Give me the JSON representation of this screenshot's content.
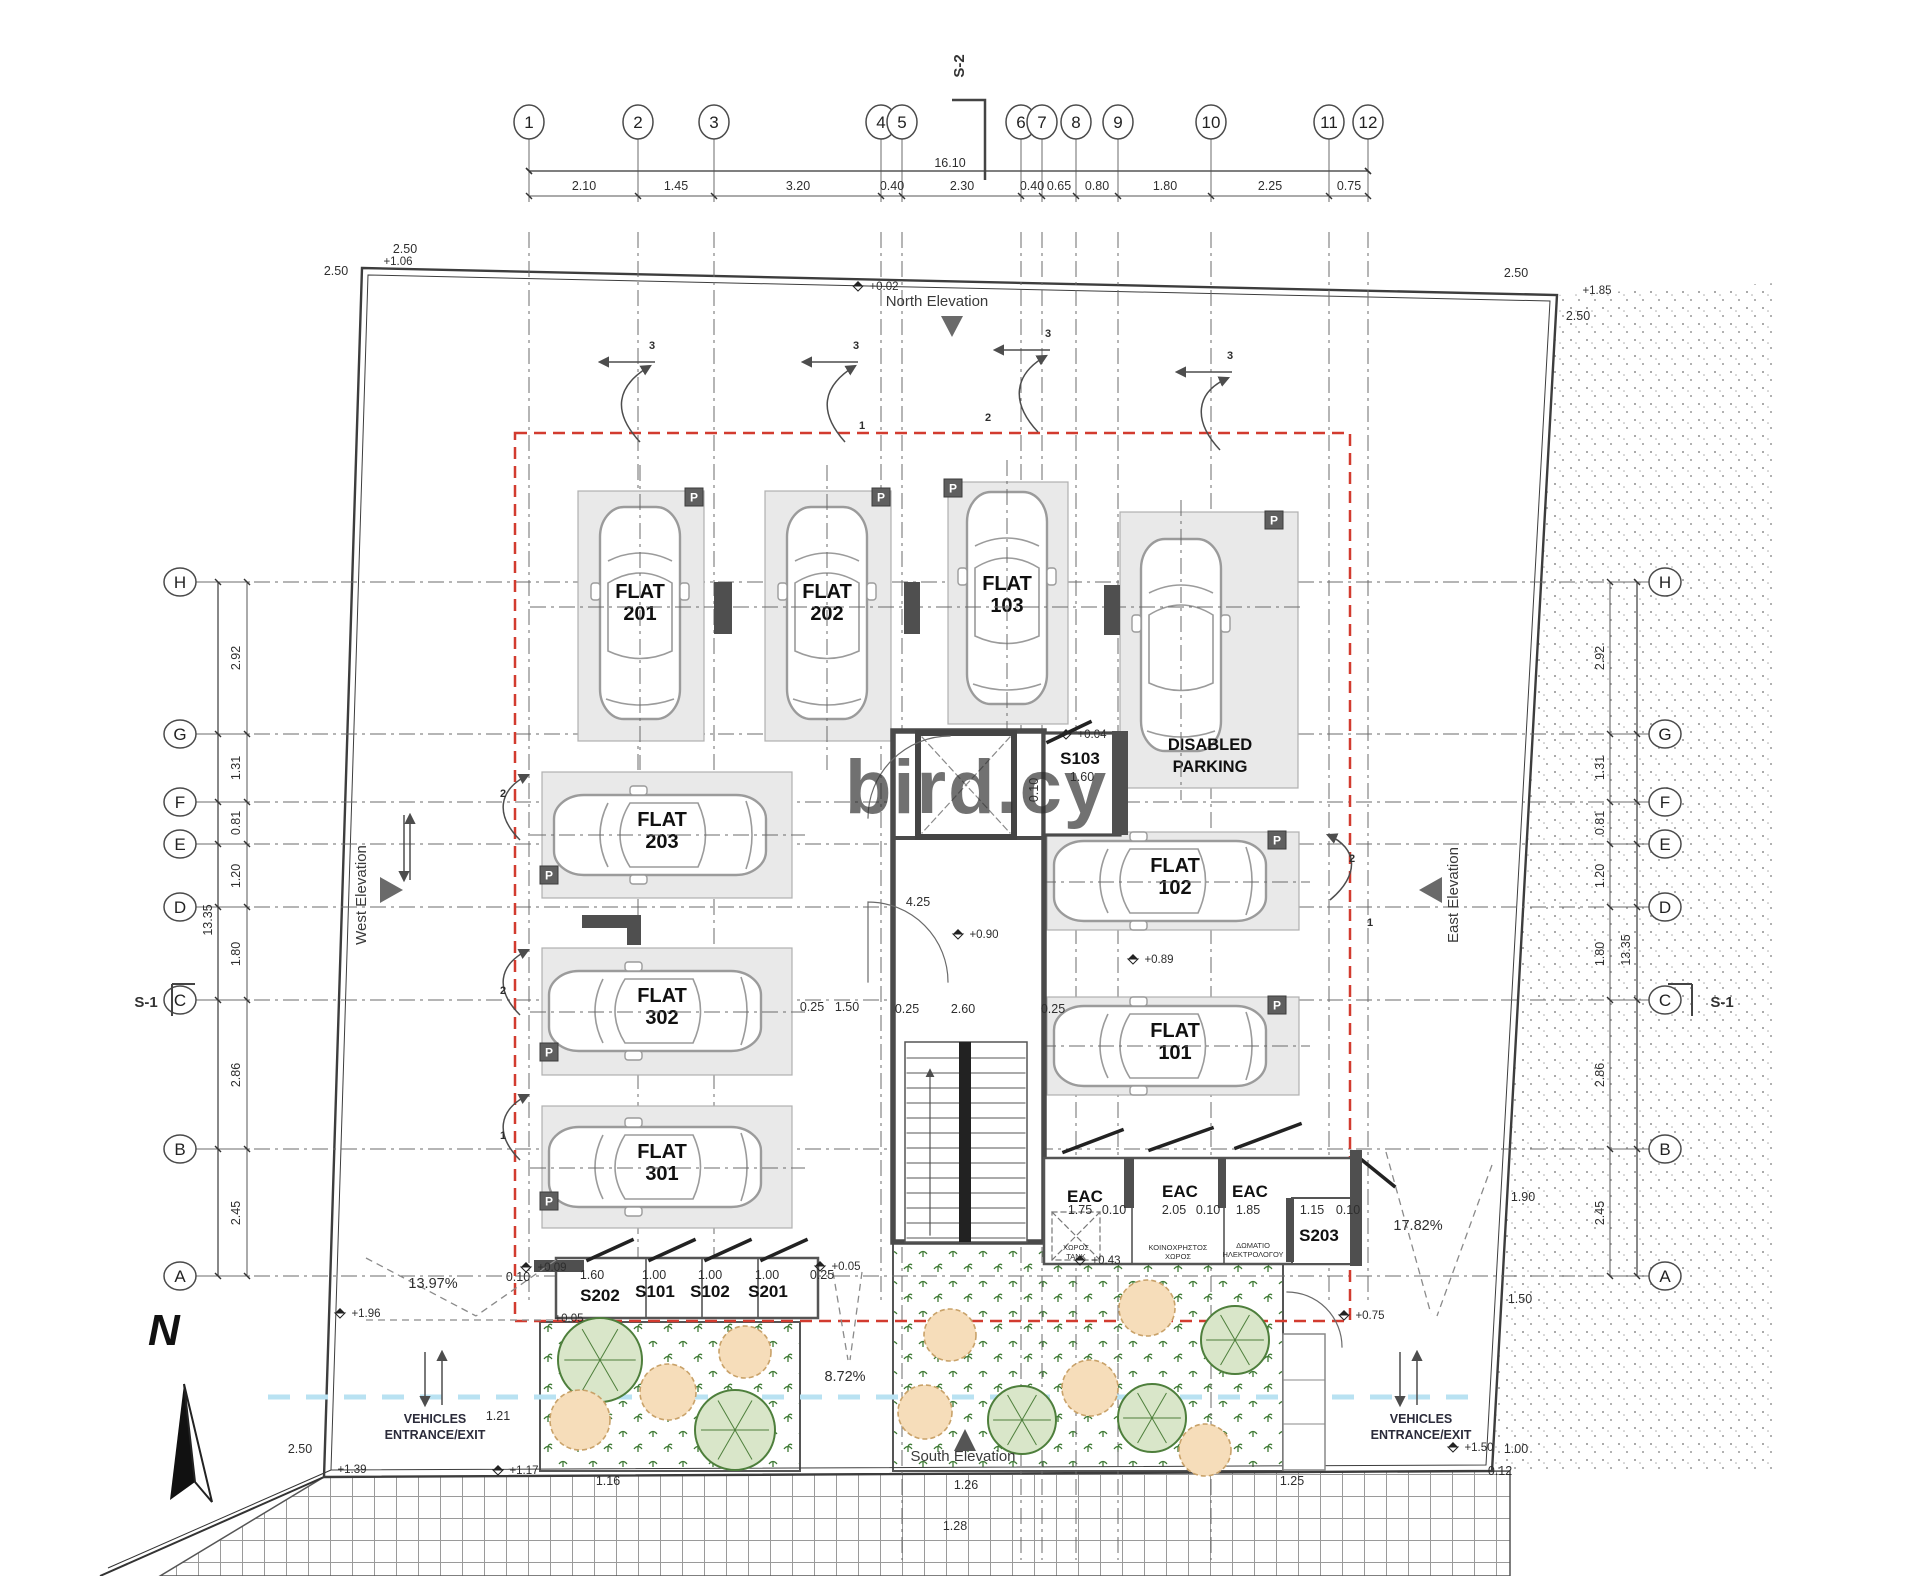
{
  "watermark": {
    "text": "bird.cy",
    "color": "#6e8ec9"
  },
  "compass": {
    "label": "N"
  },
  "section_labels": {
    "s2": "S-2",
    "s1_left": "S-1",
    "s1_right": "S-1"
  },
  "elevation_labels": {
    "north": "North Elevation",
    "south": "South Elevation",
    "west": "West Elevation",
    "east": "East Elevation"
  },
  "entrance_left": {
    "line1": "VEHICLES",
    "line2": "ENTRANCE/EXIT"
  },
  "entrance_right": {
    "line1": "VEHICLES",
    "line2": "ENTRANCE/EXIT"
  },
  "parking_icon": {
    "glyph": "P"
  },
  "grid": {
    "bubble_y": 122,
    "row_x_left": 180,
    "row_x_right": 1665,
    "columns": [
      {
        "label": "1",
        "x": 529
      },
      {
        "label": "2",
        "x": 638
      },
      {
        "label": "3",
        "x": 714
      },
      {
        "label": "4",
        "x": 881
      },
      {
        "label": "5",
        "x": 902
      },
      {
        "label": "6",
        "x": 1021
      },
      {
        "label": "7",
        "x": 1042
      },
      {
        "label": "8",
        "x": 1076
      },
      {
        "label": "9",
        "x": 1118
      },
      {
        "label": "10",
        "x": 1211
      },
      {
        "label": "11",
        "x": 1329
      },
      {
        "label": "12",
        "x": 1368
      }
    ],
    "rows": [
      {
        "label": "H",
        "y": 582
      },
      {
        "label": "G",
        "y": 734
      },
      {
        "label": "F",
        "y": 802
      },
      {
        "label": "E",
        "y": 844
      },
      {
        "label": "D",
        "y": 907
      },
      {
        "label": "C",
        "y": 1000
      },
      {
        "label": "B",
        "y": 1149
      },
      {
        "label": "A",
        "y": 1276
      }
    ]
  },
  "dims": {
    "top_total": "16.10",
    "left_total": "13.35",
    "right_total": "13.35",
    "top_segments": [
      {
        "t": "2.10",
        "x": 584
      },
      {
        "t": "1.45",
        "x": 676
      },
      {
        "t": "3.20",
        "x": 798
      },
      {
        "t": "0.40",
        "x": 892
      },
      {
        "t": "2.30",
        "x": 962
      },
      {
        "t": "0.40",
        "x": 1032
      },
      {
        "t": "0.65",
        "x": 1059
      },
      {
        "t": "0.80",
        "x": 1097
      },
      {
        "t": "1.80",
        "x": 1165
      },
      {
        "t": "2.25",
        "x": 1270
      },
      {
        "t": "0.75",
        "x": 1349
      }
    ],
    "left_segments": [
      {
        "t": "2.92",
        "y": 658
      },
      {
        "t": "1.31",
        "y": 768
      },
      {
        "t": "0.81",
        "y": 823
      },
      {
        "t": "1.20",
        "y": 876
      },
      {
        "t": "1.80",
        "y": 954
      },
      {
        "t": "2.86",
        "y": 1075
      },
      {
        "t": "2.45",
        "y": 1213
      }
    ],
    "right_segments": [
      {
        "t": "2.92",
        "y": 658
      },
      {
        "t": "1.31",
        "y": 768
      },
      {
        "t": "0.81",
        "y": 823
      },
      {
        "t": "1.20",
        "y": 876
      },
      {
        "t": "1.80",
        "y": 954
      },
      {
        "t": "2.86",
        "y": 1075
      },
      {
        "t": "2.45",
        "y": 1213
      }
    ]
  },
  "stalls": [
    {
      "id": "stall-flat-201",
      "line1": "FLAT",
      "line2": "201",
      "x": 578,
      "y": 491,
      "w": 126,
      "h": 250,
      "car": "v",
      "cx": 640,
      "cy": 613,
      "lx": 640,
      "ly": 598,
      "p": [
        694,
        497
      ]
    },
    {
      "id": "stall-flat-202",
      "line1": "FLAT",
      "line2": "202",
      "x": 765,
      "y": 491,
      "w": 126,
      "h": 250,
      "car": "v",
      "cx": 827,
      "cy": 613,
      "lx": 827,
      "ly": 598,
      "p": [
        881,
        497
      ]
    },
    {
      "id": "stall-flat-103",
      "line1": "FLAT",
      "line2": "103",
      "x": 948,
      "y": 482,
      "w": 120,
      "h": 242,
      "car": "v",
      "cx": 1007,
      "cy": 598,
      "lx": 1007,
      "ly": 590,
      "p": [
        953,
        488
      ]
    },
    {
      "id": "stall-disabled",
      "line1": "DISABLED",
      "line2": "PARKING",
      "x": 1120,
      "y": 512,
      "w": 178,
      "h": 276,
      "car": "v",
      "cx": 1181,
      "cy": 645,
      "lx": 1210,
      "ly": 750,
      "p": [
        1274,
        520
      ],
      "dis": 1
    },
    {
      "id": "stall-flat-203",
      "line1": "FLAT",
      "line2": "203",
      "x": 542,
      "y": 772,
      "w": 250,
      "h": 126,
      "car": "h",
      "cx": 660,
      "cy": 835,
      "lx": 662,
      "ly": 826,
      "p": [
        549,
        875
      ]
    },
    {
      "id": "stall-flat-302",
      "line1": "FLAT",
      "line2": "302",
      "x": 542,
      "y": 948,
      "w": 250,
      "h": 127,
      "car": "h",
      "cx": 655,
      "cy": 1011,
      "lx": 662,
      "ly": 1002,
      "p": [
        549,
        1052
      ]
    },
    {
      "id": "stall-flat-301",
      "line1": "FLAT",
      "line2": "301",
      "x": 542,
      "y": 1106,
      "w": 250,
      "h": 122,
      "car": "h",
      "cx": 655,
      "cy": 1167,
      "lx": 662,
      "ly": 1158,
      "p": [
        549,
        1201
      ]
    },
    {
      "id": "stall-flat-102",
      "line1": "FLAT",
      "line2": "102",
      "x": 1047,
      "y": 832,
      "w": 252,
      "h": 98,
      "car": "h",
      "cx": 1160,
      "cy": 881,
      "lx": 1175,
      "ly": 872,
      "p": [
        1277,
        840
      ]
    },
    {
      "id": "stall-flat-101",
      "line1": "FLAT",
      "line2": "101",
      "x": 1047,
      "y": 997,
      "w": 252,
      "h": 98,
      "car": "h",
      "cx": 1160,
      "cy": 1046,
      "lx": 1175,
      "ly": 1037,
      "p": [
        1277,
        1005
      ]
    }
  ],
  "texts": [
    {
      "t": "4.25",
      "x": 918,
      "y": 906,
      "c": "d"
    },
    {
      "t": "0.25",
      "x": 812,
      "y": 1011,
      "c": "d"
    },
    {
      "t": "1.50",
      "x": 847,
      "y": 1011,
      "c": "d"
    },
    {
      "t": "0.25",
      "x": 907,
      "y": 1013,
      "c": "d"
    },
    {
      "t": "2.60",
      "x": 963,
      "y": 1013,
      "c": "d"
    },
    {
      "t": "0.25",
      "x": 1053,
      "y": 1013,
      "c": "d"
    },
    {
      "t": "1.60",
      "x": 1082,
      "y": 781,
      "c": "d"
    },
    {
      "t": "0.10",
      "x": 1038,
      "y": 790,
      "c": "d",
      "r": 1
    },
    {
      "t": "1.60",
      "x": 592,
      "y": 1279,
      "c": "d"
    },
    {
      "t": "1.00",
      "x": 654,
      "y": 1279,
      "c": "d"
    },
    {
      "t": "1.00",
      "x": 710,
      "y": 1279,
      "c": "d"
    },
    {
      "t": "1.00",
      "x": 767,
      "y": 1279,
      "c": "d"
    },
    {
      "t": "0.25",
      "x": 822,
      "y": 1279,
      "c": "d"
    },
    {
      "t": "0.10",
      "x": 518,
      "y": 1281,
      "c": "d"
    },
    {
      "t": "1.75",
      "x": 1080,
      "y": 1214,
      "c": "d"
    },
    {
      "t": "0.10",
      "x": 1114,
      "y": 1214,
      "c": "d"
    },
    {
      "t": "2.05",
      "x": 1174,
      "y": 1214,
      "c": "d"
    },
    {
      "t": "0.10",
      "x": 1208,
      "y": 1214,
      "c": "d"
    },
    {
      "t": "1.85",
      "x": 1248,
      "y": 1214,
      "c": "d"
    },
    {
      "t": "1.15",
      "x": 1312,
      "y": 1214,
      "c": "d"
    },
    {
      "t": "0.10",
      "x": 1348,
      "y": 1214,
      "c": "d"
    },
    {
      "t": "1.90",
      "x": 1523,
      "y": 1201,
      "c": "d"
    },
    {
      "t": "1.50",
      "x": 1520,
      "y": 1303,
      "c": "d"
    },
    {
      "t": "1.00",
      "x": 1516,
      "y": 1453,
      "c": "d"
    },
    {
      "t": "0.12",
      "x": 1500,
      "y": 1475,
      "c": "d"
    },
    {
      "t": "1.21",
      "x": 498,
      "y": 1420,
      "c": "d"
    },
    {
      "t": "1.26",
      "x": 966,
      "y": 1489,
      "c": "d"
    },
    {
      "t": "1.16",
      "x": 608,
      "y": 1485,
      "c": "d"
    },
    {
      "t": "1.25",
      "x": 1292,
      "y": 1485,
      "c": "d"
    },
    {
      "t": "1.28",
      "x": 955,
      "y": 1530,
      "c": "d"
    },
    {
      "t": "2.50",
      "x": 405,
      "y": 253,
      "c": "d"
    },
    {
      "t": "2.50",
      "x": 336,
      "y": 275,
      "c": "d"
    },
    {
      "t": "2.50",
      "x": 1516,
      "y": 277,
      "c": "d"
    },
    {
      "t": "2.50",
      "x": 1578,
      "y": 320,
      "c": "d"
    },
    {
      "t": "2.50",
      "x": 300,
      "y": 1453,
      "c": "d"
    },
    {
      "t": "+0.02",
      "x": 884,
      "y": 290,
      "c": "l",
      "m": 1
    },
    {
      "t": "+1.06",
      "x": 398,
      "y": 265,
      "c": "l"
    },
    {
      "t": "+1.85",
      "x": 1597,
      "y": 294,
      "c": "l"
    },
    {
      "t": "+1.96",
      "x": 366,
      "y": 1317,
      "c": "l",
      "m": 1
    },
    {
      "t": "+1.39",
      "x": 352,
      "y": 1473,
      "c": "l"
    },
    {
      "t": "+1.17",
      "x": 524,
      "y": 1474,
      "c": "l",
      "m": 1
    },
    {
      "t": "+0.09",
      "x": 552,
      "y": 1271,
      "c": "l",
      "m": 1
    },
    {
      "t": "+0.05",
      "x": 569,
      "y": 1322,
      "c": "l"
    },
    {
      "t": "+0.05",
      "x": 846,
      "y": 1270,
      "c": "l",
      "m": 1
    },
    {
      "t": "+0.90",
      "x": 984,
      "y": 938,
      "c": "l",
      "m": 1
    },
    {
      "t": "+0.04",
      "x": 1092,
      "y": 738,
      "c": "l",
      "m": 1
    },
    {
      "t": "+0.89",
      "x": 1159,
      "y": 963,
      "c": "l",
      "m": 1
    },
    {
      "t": "+0.43",
      "x": 1106,
      "y": 1264,
      "c": "l",
      "m": 1
    },
    {
      "t": "+0.75",
      "x": 1370,
      "y": 1319,
      "c": "l",
      "m": 1
    },
    {
      "t": "+1.50",
      "x": 1479,
      "y": 1451,
      "c": "l",
      "m": 1
    },
    {
      "t": "13.97%",
      "x": 433,
      "y": 1288,
      "c": "pct"
    },
    {
      "t": "17.82%",
      "x": 1418,
      "y": 1230,
      "c": "pct"
    },
    {
      "t": "8.72%",
      "x": 845,
      "y": 1381,
      "c": "pct"
    },
    {
      "t": "3",
      "x": 652,
      "y": 349,
      "c": "p"
    },
    {
      "t": "3",
      "x": 856,
      "y": 349,
      "c": "p"
    },
    {
      "t": "3",
      "x": 1048,
      "y": 337,
      "c": "p"
    },
    {
      "t": "3",
      "x": 1230,
      "y": 359,
      "c": "p"
    },
    {
      "t": "1",
      "x": 862,
      "y": 429,
      "c": "p"
    },
    {
      "t": "2",
      "x": 988,
      "y": 421,
      "c": "p"
    },
    {
      "t": "2",
      "x": 503,
      "y": 797,
      "c": "p"
    },
    {
      "t": "2",
      "x": 503,
      "y": 994,
      "c": "p"
    },
    {
      "t": "1",
      "x": 503,
      "y": 1139,
      "c": "p"
    },
    {
      "t": "2",
      "x": 1352,
      "y": 862,
      "c": "p"
    },
    {
      "t": "1",
      "x": 1370,
      "y": 926,
      "c": "p"
    },
    {
      "t": "S103",
      "x": 1080,
      "y": 764,
      "c": "r"
    },
    {
      "t": "EAC",
      "x": 1085,
      "y": 1202,
      "c": "r"
    },
    {
      "t": "EAC",
      "x": 1180,
      "y": 1197,
      "c": "r"
    },
    {
      "t": "EAC",
      "x": 1250,
      "y": 1197,
      "c": "r"
    },
    {
      "t": "S203",
      "x": 1319,
      "y": 1241,
      "c": "r"
    },
    {
      "t": "S202",
      "x": 600,
      "y": 1301,
      "c": "r"
    },
    {
      "t": "S101",
      "x": 655,
      "y": 1297,
      "c": "r"
    },
    {
      "t": "S102",
      "x": 710,
      "y": 1297,
      "c": "r"
    },
    {
      "t": "S201",
      "x": 768,
      "y": 1297,
      "c": "r"
    },
    {
      "t": "ΧΩΡΟΣ",
      "x": 1076,
      "y": 1250,
      "c": "s"
    },
    {
      "t": "ΤΑΝΚ",
      "x": 1076,
      "y": 1259,
      "c": "s"
    },
    {
      "t": "ΚΟΙΝΟΧΡΗΣΤΟΣ",
      "x": 1178,
      "y": 1250,
      "c": "s"
    },
    {
      "t": "ΧΩΡΟΣ",
      "x": 1178,
      "y": 1259,
      "c": "s"
    },
    {
      "t": "ΔΩΜΑΤΙΟ",
      "x": 1253,
      "y": 1248,
      "c": "s"
    },
    {
      "t": "ΗΛΕΚΤΡΟΛΟΓΟΥ",
      "x": 1253,
      "y": 1257,
      "c": "s"
    }
  ],
  "trees": [
    {
      "type": "green",
      "x": 600,
      "y": 1360,
      "r": 42
    },
    {
      "type": "orange",
      "x": 580,
      "y": 1420,
      "r": 30
    },
    {
      "type": "orange",
      "x": 668,
      "y": 1392,
      "r": 28
    },
    {
      "type": "green",
      "x": 735,
      "y": 1430,
      "r": 40
    },
    {
      "type": "orange",
      "x": 745,
      "y": 1352,
      "r": 26
    },
    {
      "type": "orange",
      "x": 950,
      "y": 1335,
      "r": 26
    },
    {
      "type": "orange",
      "x": 1147,
      "y": 1308,
      "r": 28
    },
    {
      "type": "orange",
      "x": 925,
      "y": 1412,
      "r": 27
    },
    {
      "type": "green",
      "x": 1022,
      "y": 1420,
      "r": 34
    },
    {
      "type": "orange",
      "x": 1090,
      "y": 1388,
      "r": 28
    },
    {
      "type": "green",
      "x": 1152,
      "y": 1418,
      "r": 34
    },
    {
      "type": "green",
      "x": 1235,
      "y": 1340,
      "r": 34
    },
    {
      "type": "orange",
      "x": 1205,
      "y": 1450,
      "r": 26
    }
  ]
}
